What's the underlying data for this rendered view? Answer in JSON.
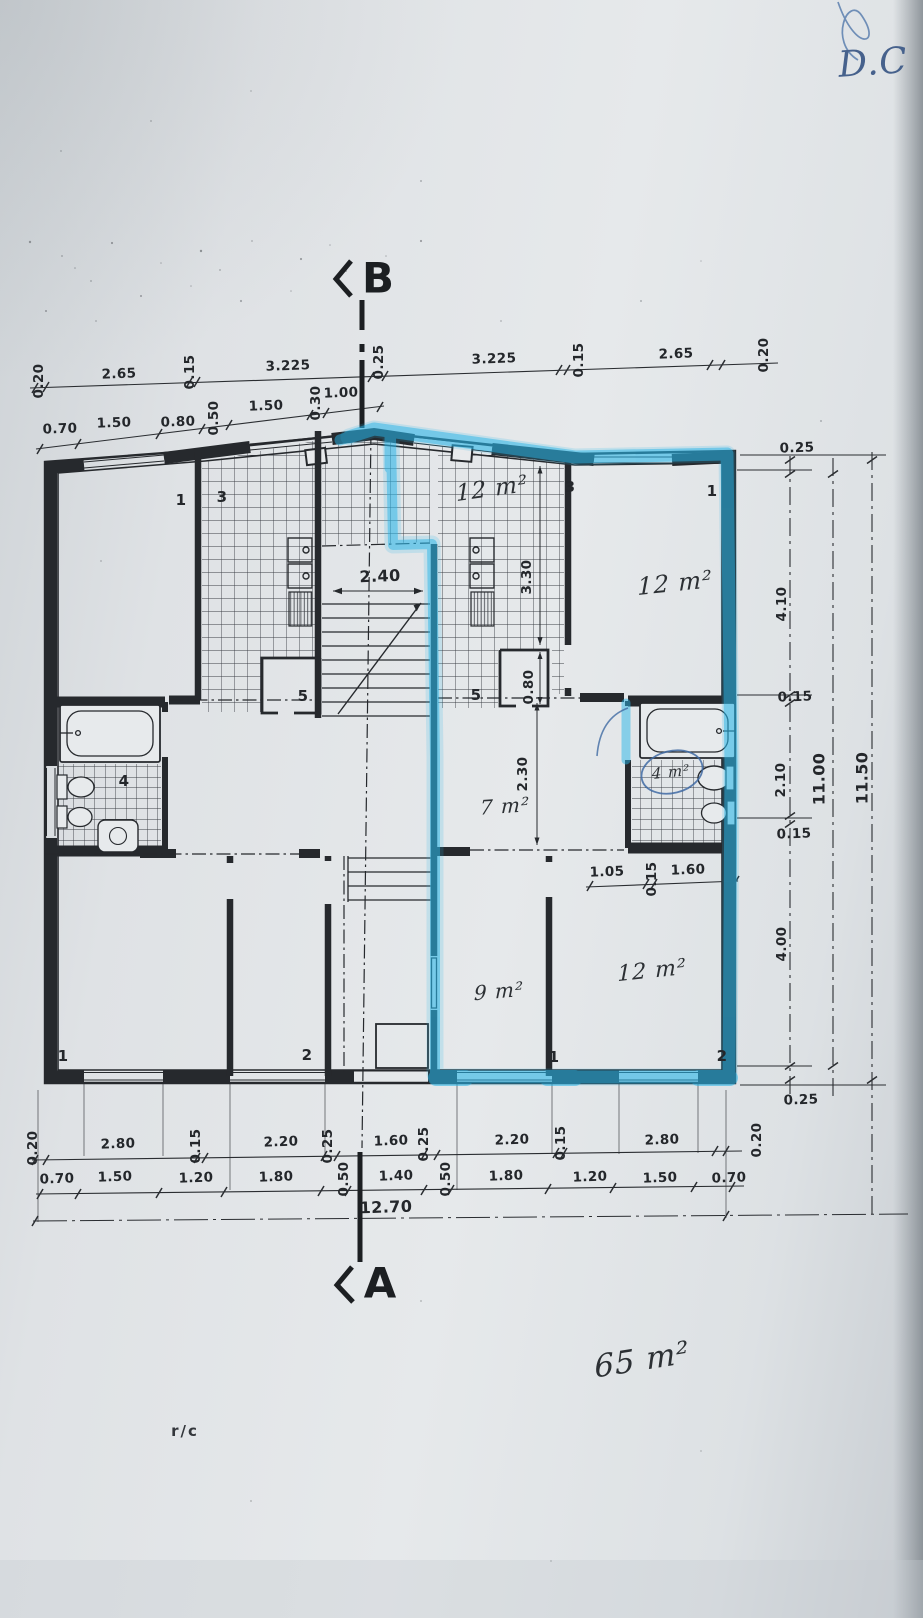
{
  "sections": {
    "top_marker": "B",
    "bottom_marker": "A"
  },
  "dims": {
    "top_outer": [
      "0.20",
      "2.65",
      "0.15",
      "3.225",
      "0.25",
      "3.225",
      "0.15",
      "2.65",
      "0.20"
    ],
    "top_inner": [
      "0.70",
      "1.50",
      "0.80",
      "0.50",
      "1.50",
      "0.30",
      "1.00"
    ],
    "right_chain": [
      "0.25",
      "4.10",
      "0.15",
      "2.10",
      "0.15",
      "4.00",
      "0.25"
    ],
    "right_total_inner": "11.00",
    "right_total_outer": "11.50",
    "bottom_outer": [
      "0.20",
      "2.80",
      "0.15",
      "2.20",
      "0.25",
      "1.60",
      "0.25",
      "2.20",
      "0.15",
      "2.80",
      "0.20"
    ],
    "bottom_inner": [
      "0.70",
      "1.50",
      "1.20",
      "1.80",
      "0.50",
      "1.40",
      "0.50",
      "1.80",
      "1.20",
      "1.50",
      "0.70"
    ],
    "bottom_total": "12.70",
    "stair_width": "2.40",
    "kitchen_depth": "3.30",
    "closet_width": "0.80",
    "hall_depth": "2.30",
    "bath_chain": [
      "1.05",
      "0.15",
      "1.60"
    ]
  },
  "room_markers": {
    "left_bedroom": "1",
    "left_kitchen": "3",
    "right_kitchen": "3",
    "right_living": "1",
    "left_bath": "4",
    "left_closet": "5",
    "right_closet": "5",
    "bottom_left_1": "1",
    "bottom_left_2": "2",
    "bottom_right_1": "1",
    "bottom_right_2": "2"
  },
  "handwritten": {
    "right_kitchen_area": "12 m²",
    "right_living_area": "12 m²",
    "hall_area": "7 m²",
    "right_bath_area": "4 m²",
    "bottom_mid_area": "9 m²",
    "bottom_right_area": "12 m²",
    "total_area": "65 m²",
    "corner_note": "D.C"
  },
  "printed": {
    "floor_label": "r/c"
  },
  "colors": {
    "paper": "#e2e5e7",
    "ink": "#24272b",
    "highlighter": "#2fb3e8",
    "pen_ink": "#44618e"
  }
}
